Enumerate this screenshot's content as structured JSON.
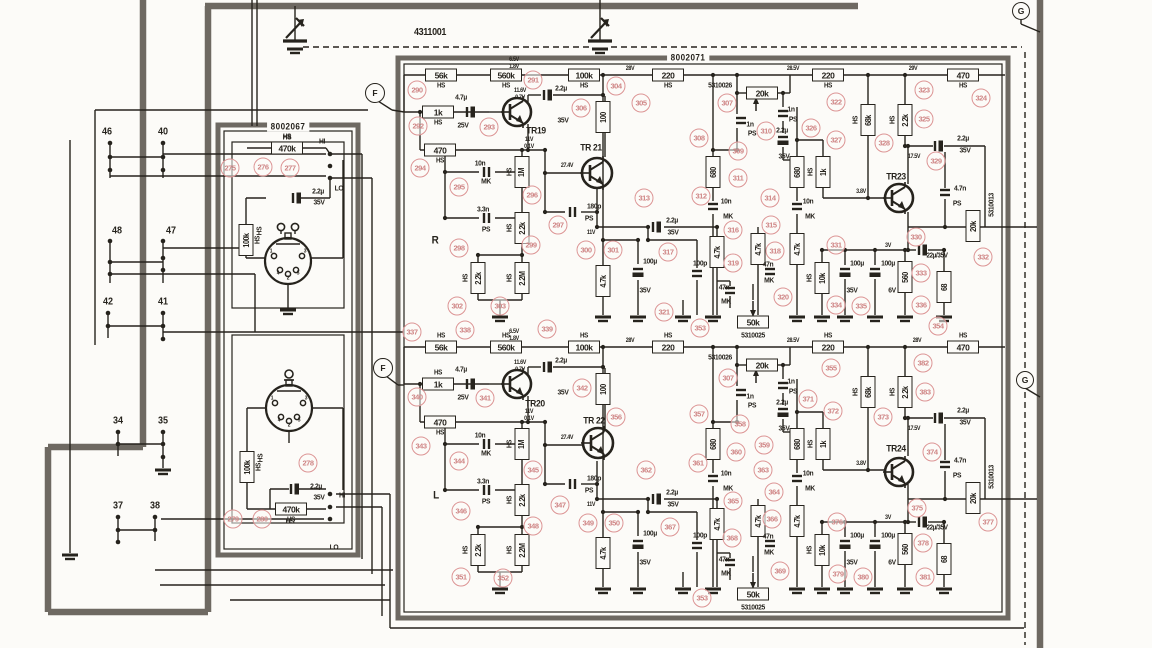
{
  "palette": {
    "paper": "#fcfbf8",
    "ink": "#26231d",
    "shield": "#6e6962",
    "ref_red": "#cf8585"
  },
  "module_labels": [
    {
      "t": "4311001",
      "x": 430,
      "y": 33,
      "s": 10
    },
    {
      "t": "8002071",
      "x": 688,
      "y": 58,
      "s": 9,
      "bg": 1
    },
    {
      "t": "8002067",
      "x": 288,
      "y": 127,
      "s": 9,
      "bg": 1
    }
  ],
  "channel_letters": [
    {
      "t": "R",
      "x": 435,
      "y": 241,
      "s": 11
    },
    {
      "t": "L",
      "x": 436,
      "y": 496,
      "s": 11
    }
  ],
  "junctions": [
    {
      "t": "F",
      "x": 375,
      "y": 93
    },
    {
      "t": "F",
      "x": 383,
      "y": 368
    },
    {
      "t": "G",
      "x": 1021,
      "y": 11
    },
    {
      "t": "G",
      "x": 1025,
      "y": 380
    }
  ],
  "pins": [
    {
      "t": "46",
      "x": 107,
      "y": 132
    },
    {
      "t": "40",
      "x": 163,
      "y": 132
    },
    {
      "t": "48",
      "x": 117,
      "y": 231
    },
    {
      "t": "47",
      "x": 171,
      "y": 231
    },
    {
      "t": "42",
      "x": 108,
      "y": 302
    },
    {
      "t": "41",
      "x": 163,
      "y": 302
    },
    {
      "t": "34",
      "x": 118,
      "y": 421
    },
    {
      "t": "35",
      "x": 163,
      "y": 421
    },
    {
      "t": "37",
      "x": 118,
      "y": 506
    },
    {
      "t": "38",
      "x": 155,
      "y": 506
    }
  ],
  "din_pins": [
    "1",
    "4",
    "2",
    "5",
    "3"
  ],
  "transistor_labels": [
    {
      "t": "TR19",
      "x": 536,
      "y": 131
    },
    {
      "t": "TR 21",
      "x": 591,
      "y": 148
    },
    {
      "t": "TR23",
      "x": 896,
      "y": 177
    },
    {
      "t": "TR20",
      "x": 535,
      "y": 404
    },
    {
      "t": "TR 22",
      "x": 594,
      "y": 421
    },
    {
      "t": "TR24",
      "x": 896,
      "y": 449
    }
  ],
  "mirrored": {
    "dy": 272,
    "boxes_h": [
      {
        "t": "56k",
        "x": 441,
        "y": 75
      },
      {
        "t": "560k",
        "x": 506,
        "y": 75
      },
      {
        "t": "100k",
        "x": 584,
        "y": 75
      },
      {
        "t": "220",
        "x": 668,
        "y": 75
      },
      {
        "t": "220",
        "x": 828,
        "y": 75
      },
      {
        "t": "470",
        "x": 963,
        "y": 75
      },
      {
        "t": "1k",
        "x": 438,
        "y": 112
      },
      {
        "t": "470",
        "x": 440,
        "y": 150,
        "keep": "b"
      }
    ],
    "pots": [
      {
        "t": "20k",
        "x": 762,
        "y": 93,
        "dir": "up"
      },
      {
        "t": "50k",
        "x": 753,
        "y": 322,
        "dir": "down"
      }
    ],
    "boxes_v": [
      {
        "t": "100",
        "x": 603,
        "y": 117
      },
      {
        "t": "1M",
        "x": 522,
        "y": 172,
        "hs": "l"
      },
      {
        "t": "2.2k",
        "x": 522,
        "y": 228,
        "hs": "l"
      },
      {
        "t": "2.2k",
        "x": 478,
        "y": 278,
        "hs": "l"
      },
      {
        "t": "2.2M",
        "x": 522,
        "y": 278,
        "hs": "l"
      },
      {
        "t": "4.7k",
        "x": 603,
        "y": 281
      },
      {
        "t": "680",
        "x": 713,
        "y": 172
      },
      {
        "t": "680",
        "x": 797,
        "y": 172
      },
      {
        "t": "1k",
        "x": 823,
        "y": 172,
        "hs": "l"
      },
      {
        "t": "4.7k",
        "x": 717,
        "y": 252
      },
      {
        "t": "4.7k",
        "x": 758,
        "y": 249
      },
      {
        "t": "4.7k",
        "x": 797,
        "y": 249
      },
      {
        "t": "10k",
        "x": 822,
        "y": 278,
        "hs": "l"
      },
      {
        "t": "68k",
        "x": 868,
        "y": 120,
        "hs": "l"
      },
      {
        "t": "2.2k",
        "x": 905,
        "y": 120,
        "hs": "l"
      },
      {
        "t": "560",
        "x": 905,
        "y": 277
      },
      {
        "t": "68",
        "x": 944,
        "y": 287
      },
      {
        "t": "20k",
        "x": 973,
        "y": 226
      }
    ],
    "caps": [
      {
        "x": 470,
        "y": 112,
        "o": "v",
        "e": 1
      },
      {
        "x": 547,
        "y": 95,
        "o": "v",
        "e": 1
      },
      {
        "x": 487,
        "y": 172,
        "o": "v"
      },
      {
        "x": 487,
        "y": 218,
        "o": "v"
      },
      {
        "x": 573,
        "y": 212,
        "o": "v"
      },
      {
        "x": 656,
        "y": 227,
        "o": "v",
        "e": 1
      },
      {
        "x": 638,
        "y": 272,
        "o": "h",
        "e": 1
      },
      {
        "x": 741,
        "y": 121,
        "o": "h"
      },
      {
        "x": 783,
        "y": 114,
        "o": "h"
      },
      {
        "x": 783,
        "y": 140,
        "o": "h",
        "e": 1
      },
      {
        "x": 713,
        "y": 207,
        "o": "h"
      },
      {
        "x": 797,
        "y": 207,
        "o": "h"
      },
      {
        "x": 697,
        "y": 274,
        "o": "h"
      },
      {
        "x": 770,
        "y": 272,
        "o": "h"
      },
      {
        "x": 730,
        "y": 291,
        "o": "h"
      },
      {
        "x": 845,
        "y": 272,
        "o": "h",
        "e": 1
      },
      {
        "x": 875,
        "y": 272,
        "o": "h",
        "e": 1
      },
      {
        "x": 922,
        "y": 250,
        "o": "v",
        "e": 1
      },
      {
        "x": 938,
        "y": 146,
        "o": "v",
        "e": 1
      },
      {
        "x": 945,
        "y": 193,
        "o": "h"
      }
    ],
    "texts": [
      {
        "t": "4.7µ",
        "x": 461,
        "y": 97
      },
      {
        "t": "25V",
        "x": 463,
        "y": 125
      },
      {
        "t": "2.2µ",
        "x": 561,
        "y": 88
      },
      {
        "t": "35V",
        "x": 563,
        "y": 120
      },
      {
        "t": "10n",
        "x": 480,
        "y": 163
      },
      {
        "t": "MK",
        "x": 486,
        "y": 181
      },
      {
        "t": "3.3n",
        "x": 483,
        "y": 209
      },
      {
        "t": "PS",
        "x": 486,
        "y": 229
      },
      {
        "t": "180p",
        "x": 594,
        "y": 206
      },
      {
        "t": "PS",
        "x": 589,
        "y": 218
      },
      {
        "t": "11V",
        "x": 591,
        "y": 233,
        "s": 6
      },
      {
        "t": "2.2µ",
        "x": 672,
        "y": 220
      },
      {
        "t": "35V",
        "x": 673,
        "y": 232
      },
      {
        "t": "100µ",
        "x": 650,
        "y": 261
      },
      {
        "t": "35V",
        "x": 645,
        "y": 290
      },
      {
        "t": "100p",
        "x": 700,
        "y": 263
      },
      {
        "t": "5310026",
        "x": 720,
        "y": 85
      },
      {
        "t": "1n",
        "x": 750,
        "y": 124
      },
      {
        "t": "PS",
        "x": 752,
        "y": 133
      },
      {
        "t": "1n",
        "x": 791,
        "y": 109
      },
      {
        "t": "PS",
        "x": 793,
        "y": 119
      },
      {
        "t": "2.2µ",
        "x": 782,
        "y": 130
      },
      {
        "t": "35V",
        "x": 784,
        "y": 156
      },
      {
        "t": "10n",
        "x": 726,
        "y": 201
      },
      {
        "t": "MK",
        "x": 728,
        "y": 216
      },
      {
        "t": "10n",
        "x": 808,
        "y": 201
      },
      {
        "t": "MK",
        "x": 810,
        "y": 216
      },
      {
        "t": "47n",
        "x": 768,
        "y": 264
      },
      {
        "t": "MK",
        "x": 769,
        "y": 280
      },
      {
        "t": "47n",
        "x": 724,
        "y": 287
      },
      {
        "t": "MK",
        "x": 726,
        "y": 301
      },
      {
        "t": "5310025",
        "x": 753,
        "y": 335
      },
      {
        "t": "28V",
        "x": 630,
        "y": 69,
        "s": 6
      },
      {
        "t": "28.5V",
        "x": 793,
        "y": 69,
        "s": 6
      },
      {
        "t": "2.2µ",
        "x": 963,
        "y": 138
      },
      {
        "t": "35V",
        "x": 965,
        "y": 150
      },
      {
        "t": "4.7n",
        "x": 960,
        "y": 188
      },
      {
        "t": "PS",
        "x": 957,
        "y": 203
      },
      {
        "t": "5310013",
        "x": 991,
        "y": 205,
        "v": 1
      },
      {
        "t": "3V",
        "x": 888,
        "y": 246,
        "s": 6
      },
      {
        "t": "22µ/35V",
        "x": 937,
        "y": 256,
        "s": 7
      },
      {
        "t": "100µ",
        "x": 857,
        "y": 263
      },
      {
        "t": "35V",
        "x": 852,
        "y": 290
      },
      {
        "t": "100µ",
        "x": 888,
        "y": 263
      },
      {
        "t": "6V",
        "x": 892,
        "y": 290
      },
      {
        "t": "27.4V",
        "x": 567,
        "y": 166,
        "s": 6
      },
      {
        "t": "11V",
        "x": 529,
        "y": 140,
        "s": 6
      },
      {
        "t": "0.1V",
        "x": 529,
        "y": 147,
        "s": 6
      },
      {
        "t": "11.6V",
        "x": 520,
        "y": 91,
        "s": 6
      },
      {
        "t": "0.7V",
        "x": 520,
        "y": 98,
        "s": 6
      },
      {
        "t": "6.5V",
        "x": 514,
        "y": 60,
        "s": 6
      },
      {
        "t": "1.8V",
        "x": 514,
        "y": 67,
        "s": 6
      },
      {
        "t": "3.8V",
        "x": 861,
        "y": 192,
        "s": 6
      },
      {
        "t": "17.5V",
        "x": 914,
        "y": 157,
        "s": 6
      }
    ]
  },
  "unique_boxes_h": [
    {
      "t": "470k",
      "x": 287,
      "y": 148,
      "hs": "a"
    },
    {
      "t": "470k",
      "x": 291,
      "y": 509,
      "hs": "b"
    }
  ],
  "unique_boxes_v": [
    {
      "t": "100k",
      "x": 246,
      "y": 240,
      "hs": "r"
    },
    {
      "t": "100k",
      "x": 247,
      "y": 467,
      "hs": "r"
    }
  ],
  "unique_caps": [
    {
      "x": 296,
      "y": 198,
      "o": "v",
      "e": 1
    },
    {
      "x": 294,
      "y": 489,
      "o": "v",
      "e": 1
    }
  ],
  "unique_texts": [
    {
      "t": "29V",
      "x": 913,
      "y": 69,
      "s": 6
    },
    {
      "t": "28V",
      "x": 917,
      "y": 341,
      "s": 6
    },
    {
      "t": "HS",
      "x": 287,
      "y": 137
    },
    {
      "t": "HI",
      "x": 322,
      "y": 141
    },
    {
      "t": "LO",
      "x": 339,
      "y": 188
    },
    {
      "t": "2.2µ",
      "x": 318,
      "y": 191
    },
    {
      "t": "35V",
      "x": 319,
      "y": 202
    },
    {
      "t": "HS",
      "x": 259,
      "y": 231,
      "r": 1
    },
    {
      "t": "HS",
      "x": 260,
      "y": 458,
      "r": 1
    },
    {
      "t": "2.2µ",
      "x": 316,
      "y": 486
    },
    {
      "t": "35V",
      "x": 319,
      "y": 497
    },
    {
      "t": "HS",
      "x": 290,
      "y": 521
    },
    {
      "t": "HI",
      "x": 342,
      "y": 495
    },
    {
      "t": "LO",
      "x": 334,
      "y": 547
    }
  ],
  "refs": [
    [
      275,
      230,
      168
    ],
    [
      276,
      263,
      167
    ],
    [
      277,
      290,
      168
    ],
    [
      278,
      308,
      463
    ],
    [
      279,
      233,
      519
    ],
    [
      280,
      262,
      519
    ],
    [
      290,
      417,
      90
    ],
    [
      291,
      533,
      80
    ],
    [
      292,
      418,
      126
    ],
    [
      293,
      489,
      127
    ],
    [
      294,
      420,
      168
    ],
    [
      295,
      459,
      187
    ],
    [
      296,
      532,
      195
    ],
    [
      297,
      558,
      225
    ],
    [
      298,
      459,
      248
    ],
    [
      299,
      531,
      245
    ],
    [
      300,
      586,
      250
    ],
    [
      301,
      613,
      250
    ],
    [
      302,
      457,
      306
    ],
    [
      303,
      500,
      306
    ],
    [
      304,
      616,
      86
    ],
    [
      305,
      641,
      103
    ],
    [
      306,
      581,
      108
    ],
    [
      307,
      727,
      103
    ],
    [
      308,
      699,
      138
    ],
    [
      309,
      738,
      151
    ],
    [
      310,
      766,
      131
    ],
    [
      311,
      738,
      178
    ],
    [
      312,
      701,
      196
    ],
    [
      313,
      644,
      198
    ],
    [
      314,
      770,
      198
    ],
    [
      315,
      771,
      225
    ],
    [
      316,
      733,
      230
    ],
    [
      317,
      668,
      252
    ],
    [
      318,
      775,
      251
    ],
    [
      319,
      733,
      263
    ],
    [
      320,
      783,
      297
    ],
    [
      321,
      664,
      312
    ],
    [
      322,
      836,
      102
    ],
    [
      323,
      924,
      90
    ],
    [
      324,
      981,
      98
    ],
    [
      325,
      924,
      119
    ],
    [
      326,
      811,
      128
    ],
    [
      327,
      836,
      140
    ],
    [
      328,
      884,
      143
    ],
    [
      329,
      936,
      161
    ],
    [
      330,
      916,
      237
    ],
    [
      331,
      836,
      245
    ],
    [
      332,
      983,
      257
    ],
    [
      333,
      921,
      273
    ],
    [
      334,
      836,
      305
    ],
    [
      335,
      861,
      306
    ],
    [
      336,
      921,
      305
    ],
    [
      353,
      700,
      328
    ],
    [
      354,
      938,
      326
    ],
    [
      337,
      412,
      332
    ],
    [
      338,
      465,
      330
    ],
    [
      339,
      547,
      329
    ],
    [
      340,
      417,
      397
    ],
    [
      341,
      485,
      398
    ],
    [
      342,
      582,
      388
    ],
    [
      343,
      421,
      446
    ],
    [
      344,
      459,
      461
    ],
    [
      345,
      533,
      470
    ],
    [
      346,
      461,
      511
    ],
    [
      347,
      560,
      505
    ],
    [
      348,
      533,
      526
    ],
    [
      349,
      588,
      523
    ],
    [
      350,
      614,
      523
    ],
    [
      351,
      461,
      577
    ],
    [
      352,
      503,
      578
    ],
    [
      355,
      831,
      368
    ],
    [
      356,
      616,
      417
    ],
    [
      357,
      699,
      414
    ],
    [
      358,
      740,
      424
    ],
    [
      359,
      764,
      445
    ],
    [
      360,
      736,
      452
    ],
    [
      361,
      698,
      463
    ],
    [
      362,
      646,
      470
    ],
    [
      363,
      763,
      470
    ],
    [
      364,
      774,
      492
    ],
    [
      365,
      733,
      501
    ],
    [
      366,
      772,
      519
    ],
    [
      367,
      670,
      527
    ],
    [
      368,
      732,
      538
    ],
    [
      369,
      780,
      571
    ],
    [
      371,
      808,
      399
    ],
    [
      372,
      833,
      411
    ],
    [
      373,
      883,
      417
    ],
    [
      374,
      932,
      452
    ],
    [
      375,
      917,
      508
    ],
    [
      376,
      837,
      522
    ],
    [
      377,
      988,
      522
    ],
    [
      378,
      923,
      543
    ],
    [
      379,
      838,
      574
    ],
    [
      380,
      863,
      577
    ],
    [
      381,
      925,
      577
    ],
    [
      382,
      923,
      363
    ],
    [
      383,
      925,
      392
    ],
    [
      307,
      728,
      378
    ],
    [
      353,
      702,
      598
    ]
  ]
}
